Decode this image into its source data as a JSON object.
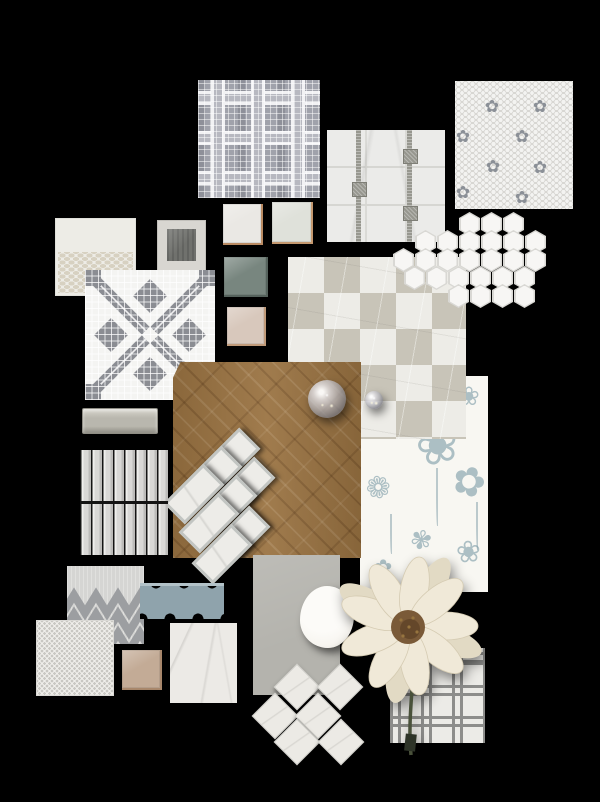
{
  "board": {
    "background": "#000000",
    "palette": {
      "white_marble": "#edece7",
      "greige": "#c8c4b8",
      "wood_oak": "#9a7342",
      "steel_blue": "#8fa3ac",
      "sage_green": "#78867f",
      "copper_edge": "#b98a62",
      "wallpaper_blue": "#7f9da8",
      "flower_cream": "#f0e9d8",
      "mosaic_gray": "#8b8d93"
    },
    "items": [
      {
        "name": "floral-wallpaper",
        "type": "wallpaper",
        "x": 360,
        "y": 376,
        "w": 128,
        "h": 216,
        "colors": {
          "bg": "#f8f7f2",
          "ink": "#7f9da8"
        },
        "glyphs": [
          {
            "ch": "❀",
            "x": 56,
            "y": 44,
            "s": 52,
            "r": -15
          },
          {
            "ch": "✾",
            "x": 26,
            "y": 12,
            "s": 30,
            "r": 10
          },
          {
            "ch": "❀",
            "x": 98,
            "y": 8,
            "s": 26,
            "r": 0
          },
          {
            "ch": "✿",
            "x": 92,
            "y": 86,
            "s": 40,
            "r": 20
          },
          {
            "ch": "❁",
            "x": 6,
            "y": 98,
            "s": 30,
            "r": -10
          },
          {
            "ch": "✾",
            "x": 50,
            "y": 152,
            "s": 26,
            "r": 15
          },
          {
            "ch": "❀",
            "x": 96,
            "y": 162,
            "s": 30,
            "r": -5
          },
          {
            "ch": "✿",
            "x": 14,
            "y": 182,
            "s": 22,
            "r": 0
          }
        ],
        "stems": [
          {
            "x": 76,
            "y": 92,
            "h": 58
          },
          {
            "x": 116,
            "y": 126,
            "h": 48
          },
          {
            "x": 30,
            "y": 138,
            "h": 40
          }
        ]
      },
      {
        "name": "plaid-mosaic-tile",
        "type": "plaid",
        "x": 198,
        "y": 80,
        "w": 122,
        "h": 118,
        "colors": {
          "base": "#a0a2ab",
          "band": "#b7b8c0",
          "white": "#f2f2f4",
          "dark": "#8e9099"
        }
      },
      {
        "name": "marble-grid-strip-tile",
        "type": "marble-strips",
        "x": 327,
        "y": 130,
        "w": 118,
        "h": 112,
        "colors": {
          "bg": "#ebebe9",
          "strip": "#97978f",
          "line": "#d6d6d2"
        },
        "strips": [
          31,
          82
        ],
        "dots": [
          {
            "x": 31,
            "y": 58
          },
          {
            "x": 82,
            "y": 25
          },
          {
            "x": 82,
            "y": 82
          }
        ]
      },
      {
        "name": "penny-flower-tile",
        "type": "hex-flower",
        "x": 455,
        "y": 81,
        "w": 118,
        "h": 128,
        "colors": {
          "bg": "#f3f3f1",
          "dot": "#d8d7d3",
          "flower": "#8b9097"
        },
        "flowers": [
          {
            "x": 37,
            "y": 26
          },
          {
            "x": 85,
            "y": 26
          },
          {
            "x": 8,
            "y": 56
          },
          {
            "x": 67,
            "y": 56
          },
          {
            "x": 38,
            "y": 86
          },
          {
            "x": 85,
            "y": 87
          },
          {
            "x": 8,
            "y": 112
          },
          {
            "x": 67,
            "y": 117
          }
        ]
      },
      {
        "name": "cream-brick-dot-tile",
        "type": "brick-dot",
        "x": 55,
        "y": 218,
        "w": 81,
        "h": 78,
        "colors": {
          "bg": "#edece6",
          "dot": "#d7d1c1"
        }
      },
      {
        "name": "framed-sample",
        "type": "framed",
        "x": 157,
        "y": 220,
        "w": 49,
        "h": 52,
        "colors": {
          "frame": "#d8d6d1",
          "inner": "#70716d"
        }
      },
      {
        "name": "white-glazed-swatch",
        "type": "swatch",
        "x": 223,
        "y": 204,
        "w": 40,
        "h": 41,
        "colors": {
          "bg": "#eae8e4",
          "edge": "#b98a62"
        }
      },
      {
        "name": "pale-green-swatch",
        "type": "swatch",
        "x": 272,
        "y": 202,
        "w": 41,
        "h": 42,
        "colors": {
          "bg": "#dfe1da",
          "edge": "#c4986f"
        }
      },
      {
        "name": "sage-green-swatch",
        "type": "swatch",
        "x": 224,
        "y": 257,
        "w": 44,
        "h": 40,
        "colors": {
          "bg": "#78867f",
          "edge": "#55625c"
        }
      },
      {
        "name": "blush-swatch",
        "type": "swatch",
        "x": 227,
        "y": 307,
        "w": 39,
        "h": 39,
        "colors": {
          "bg": "#d8c8bc",
          "edge": "#c09a79"
        }
      },
      {
        "name": "mosaic-cross-tile",
        "type": "mosaic-x",
        "x": 85,
        "y": 270,
        "w": 130,
        "h": 130,
        "colors": {
          "bg": "#f4f4f2",
          "motif": "#8b8d93"
        }
      },
      {
        "name": "checker-diamond-marble-tile",
        "type": "diamond-checker",
        "x": 288,
        "y": 257,
        "w": 178,
        "h": 182,
        "colors": {
          "light": "#edece7",
          "dark": "#c8c4b8"
        }
      },
      {
        "name": "hexagon-mosaic-cluster",
        "type": "hex-cluster",
        "x": 385,
        "y": 206,
        "w": 165,
        "h": 104,
        "colors": {
          "hex": "#f7f6f4",
          "edge": "#d9d8d4"
        },
        "rows": [
          {
            "y": 6,
            "xs": [
              74,
              96,
              118
            ]
          },
          {
            "y": 24,
            "xs": [
              30,
              52,
              74,
              96,
              118,
              140
            ]
          },
          {
            "y": 42,
            "xs": [
              8,
              30,
              52,
              74,
              96,
              118,
              140
            ]
          },
          {
            "y": 60,
            "xs": [
              19,
              41,
              63,
              85,
              107,
              129
            ]
          },
          {
            "y": 78,
            "xs": [
              63,
              85,
              107,
              129
            ]
          }
        ]
      },
      {
        "name": "herringbone-wood-floor",
        "type": "wood",
        "x": 173,
        "y": 362,
        "w": 188,
        "h": 196,
        "colors": {
          "base": "#9a7342"
        }
      },
      {
        "name": "glass-sphere-large",
        "type": "sphere",
        "x": 308,
        "y": 380,
        "w": 38,
        "h": 38
      },
      {
        "name": "glass-sphere-small",
        "type": "sphere",
        "x": 365,
        "y": 391,
        "w": 18,
        "h": 18
      },
      {
        "name": "marble-brick-stack",
        "type": "brick-stack",
        "x": 160,
        "y": 435,
        "w": 110,
        "h": 135,
        "colors": {
          "bg": "#edece8",
          "rim": "#c2c5c2"
        },
        "bricks": [
          {
            "x": 70,
            "y": 23
          },
          {
            "x": 52,
            "y": 41
          },
          {
            "x": 34,
            "y": 59
          },
          {
            "x": 85,
            "y": 52
          },
          {
            "x": 67,
            "y": 70
          },
          {
            "x": 49,
            "y": 88
          },
          {
            "x": 80,
            "y": 101
          },
          {
            "x": 62,
            "y": 119
          }
        ]
      },
      {
        "name": "greige-subway-tile",
        "type": "glazed-bar",
        "x": 82,
        "y": 408,
        "w": 76,
        "h": 26,
        "colors": {
          "bg": "#b9b7ae",
          "edge": "#8f8d84",
          "hi": "#d6d4cb"
        }
      },
      {
        "name": "kitkat-stick-tile",
        "type": "kitkat",
        "x": 80,
        "y": 450,
        "w": 88,
        "h": 105,
        "colors": {
          "a": "#f0efed",
          "b": "#d9d8d6",
          "c": "#bcbbb9",
          "gap": "#141414"
        }
      },
      {
        "name": "chevron-pattern-tile",
        "type": "chevron",
        "x": 67,
        "y": 566,
        "w": 77,
        "h": 78,
        "colors": {
          "bg": "#d5d5d3",
          "zig": "#9c9ea1"
        }
      },
      {
        "name": "blue-lace-trim-tile",
        "type": "scallop",
        "x": 140,
        "y": 583,
        "w": 84,
        "h": 36,
        "colors": {
          "bg": "#8fa3ac",
          "hi": "#b3c2c8"
        }
      },
      {
        "name": "penny-round-tile",
        "type": "penny",
        "x": 36,
        "y": 620,
        "w": 78,
        "h": 76,
        "colors": {
          "bg": "#f0efeb",
          "dot": "#c9c8c3"
        }
      },
      {
        "name": "bronze-glazed-swatch",
        "type": "swatch",
        "x": 122,
        "y": 650,
        "w": 40,
        "h": 40,
        "colors": {
          "bg": "#c3ab96",
          "edge": "#a8876b"
        }
      },
      {
        "name": "white-marble-tile",
        "type": "marble-plain",
        "x": 170,
        "y": 623,
        "w": 67,
        "h": 80,
        "colors": {
          "bg": "#eceae6"
        }
      },
      {
        "name": "gray-paint-card",
        "type": "card",
        "x": 253,
        "y": 555,
        "w": 87,
        "h": 140,
        "colors": {
          "bg": "#b4b3ad"
        }
      },
      {
        "name": "ceramic-plate",
        "type": "plate",
        "x": 300,
        "y": 586,
        "w": 54,
        "h": 62,
        "colors": {
          "bg": "#f7f5f0",
          "rim": "#dedbd3"
        }
      },
      {
        "name": "diamond-marble-mosaic",
        "type": "diamond-set",
        "x": 255,
        "y": 665,
        "w": 115,
        "h": 95,
        "colors": {
          "bg": "#eceae5",
          "edge": "#d0cfca"
        },
        "cells": [
          {
            "x": 42,
            "y": 22
          },
          {
            "x": 85,
            "y": 22
          },
          {
            "x": 20,
            "y": 51
          },
          {
            "x": 63,
            "y": 51
          },
          {
            "x": 42,
            "y": 77
          },
          {
            "x": 86,
            "y": 77
          }
        ]
      },
      {
        "name": "lattice-weave-tile",
        "type": "lattice",
        "x": 390,
        "y": 648,
        "w": 95,
        "h": 95,
        "colors": {
          "bg": "#ecebe7",
          "strip": "#8d8d8b"
        }
      },
      {
        "name": "cosmos-flower",
        "type": "flower",
        "x": 333,
        "y": 548,
        "w": 160,
        "h": 225,
        "colors": {
          "petal": "#f0e9d8",
          "petal2": "#e2dac4",
          "vein": "#d5cbb2",
          "disc": "#7a5a38",
          "disc2": "#5d4126",
          "stem": "#49513a",
          "clip": "#2e3428"
        }
      }
    ]
  }
}
